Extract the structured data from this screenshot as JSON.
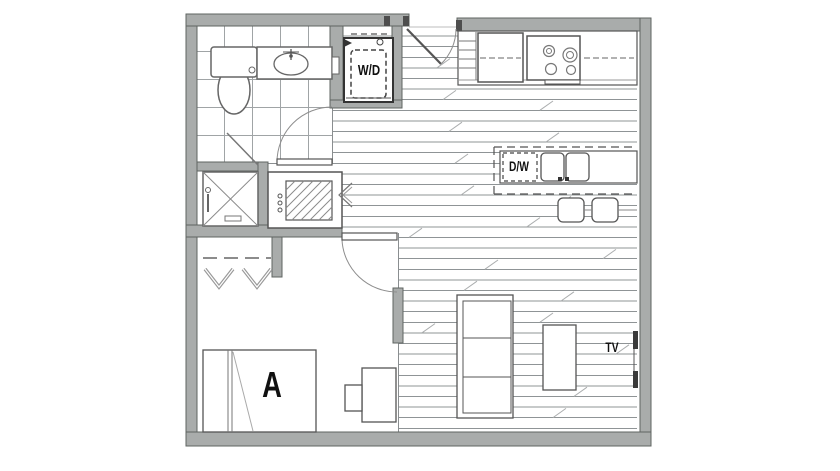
{
  "floorplan": {
    "labels": {
      "washer_dryer": "W/D",
      "dishwasher": "D/W",
      "unit_a": "A",
      "tv": "TV"
    },
    "colors": {
      "wall_fill": "#a9acab",
      "wall_edge": "#5f6462",
      "jamb_dark": "#4e4e4e",
      "fixture_line": "#606060",
      "floor_line": "#8f9496",
      "tile_line": "#a0a4a6",
      "label_text": "#101010",
      "background": "#ffffff"
    },
    "rooms": [
      "bathroom",
      "laundry-closet",
      "entry",
      "kitchen",
      "living-area",
      "bedroom",
      "closet"
    ],
    "fixtures": [
      "toilet",
      "vanity-sink",
      "shower",
      "washer-dryer",
      "refrigerator",
      "range-stove",
      "pantry-shelves",
      "kitchen-island",
      "dishwasher",
      "double-sink",
      "bar-stools",
      "water-heater-closet",
      "closet-hangers",
      "bed",
      "armchair",
      "sofa",
      "coffee-table",
      "wall-tv",
      "entry-door",
      "bathroom-door",
      "bedroom-door"
    ]
  }
}
